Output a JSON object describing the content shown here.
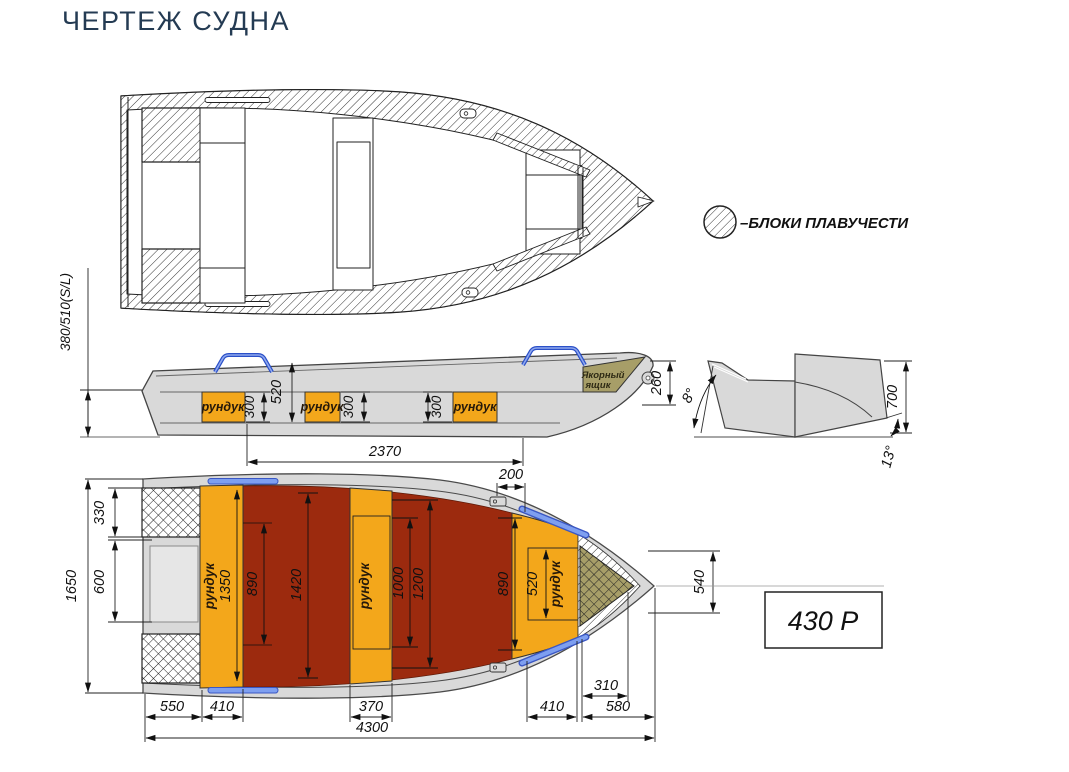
{
  "page": {
    "title": "ЧЕРТЕЖ СУДНА"
  },
  "legend": {
    "symbol": "hatched-circle",
    "label": "–БЛОКИ ПЛАВУЧЕСТИ"
  },
  "model_plate": {
    "label": "430 Р"
  },
  "colors": {
    "hull_grey": "#d9d9d9",
    "floor_red": "#9c2a0e",
    "locker_orange": "#f3a71b",
    "anchor_khaki": "#a79e68",
    "handle_blue": "#7e9ff0",
    "title_navy": "#243b53"
  },
  "side_view": {
    "locker_front_label": "рундук",
    "locker_mid_label": "рундук",
    "locker_bow_label": "рундук",
    "anchor_box_line1": "Якорный",
    "anchor_box_line2": "ящик",
    "dims": {
      "stern_height": "380/510(S/L)",
      "depth": "520",
      "locker_front_height": "300",
      "locker_mid_height": "300",
      "locker_bow_height": "300",
      "lockers_span": "2370",
      "bow_height": "260"
    }
  },
  "section_view": {
    "dims": {
      "bottom_angle": "8°",
      "height": "700",
      "deadrise_angle": "13°"
    }
  },
  "bottom_view": {
    "locker_stern_label": "рундук",
    "locker_mid_label": "рундук",
    "locker_bow_label": "рундук",
    "dims": {
      "beam": "1650",
      "block_width": "330",
      "transom_width": "600",
      "locker_stern_length": "1350",
      "floor_width_stern": "890",
      "floor_width_max": "1420",
      "locker_mid_inner": "1000",
      "locker_mid_outer": "1200",
      "floor_width_bow": "890",
      "locker_bow_width": "520",
      "fitting_offset": "200",
      "bow_width": "540",
      "anchor_length": "310",
      "stern_seg": "550",
      "locker_stern_seg": "410",
      "locker_mid_seg": "370",
      "locker_bow_seg": "410",
      "bow_seg": "580",
      "overall_length": "4300"
    }
  }
}
